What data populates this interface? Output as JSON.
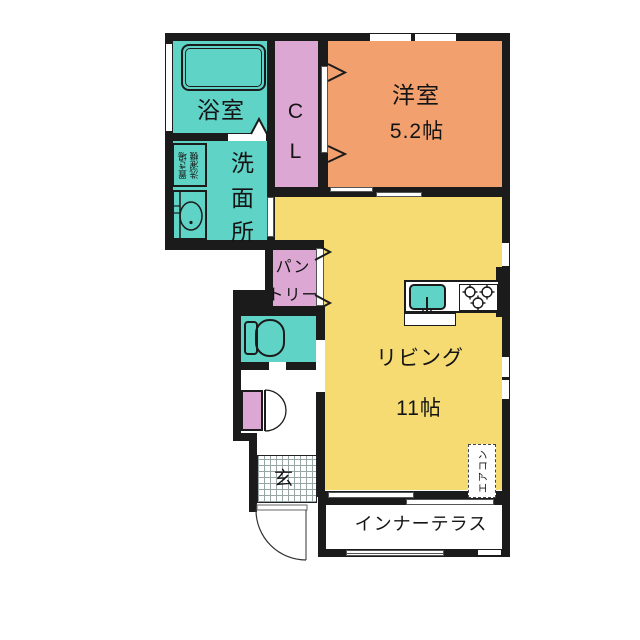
{
  "rooms": {
    "bathroom": {
      "label": "浴室"
    },
    "closet": {
      "lines": [
        "C",
        "L"
      ]
    },
    "western_room": {
      "label": "洋室",
      "size": "5.2帖"
    },
    "washroom": {
      "chars": [
        "洗",
        "面",
        "所"
      ],
      "laundry": [
        "洗濯機",
        "置き場"
      ]
    },
    "pantry": {
      "lines": [
        "パン",
        "トリー"
      ]
    },
    "living": {
      "label": "リビング",
      "size": "11帖"
    },
    "entrance": {
      "label": "玄"
    },
    "inner_terrace": {
      "label": "インナーテラス"
    },
    "aircon": {
      "label": "エアコン"
    }
  },
  "colors": {
    "room_teal": "#5fd3c6",
    "room_pink": "#dda7d3",
    "room_orange": "#f1a06e",
    "room_yellow": "#f6db72",
    "wall": "#1b1b1b"
  }
}
